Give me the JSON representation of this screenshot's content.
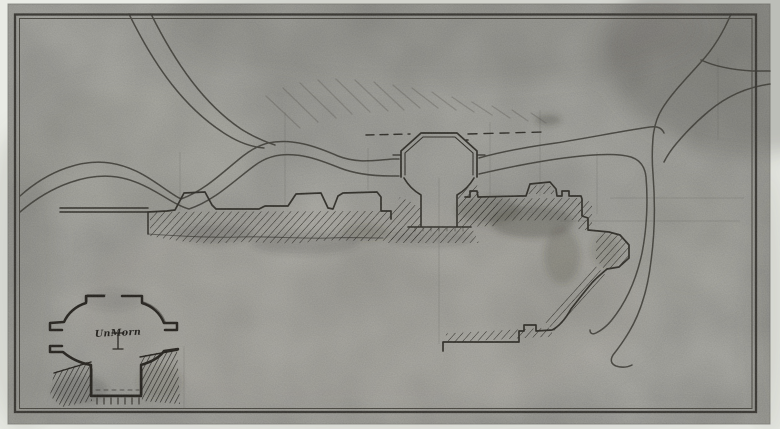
{
  "document": {
    "kind": "scanned hand-drawn architectural site plan",
    "media": "pencil and ink on toned paper"
  },
  "drawing": {
    "elements": [
      "double-line border frame",
      "curving carriage roads",
      "main building plan with hatched poche walls",
      "central octagonal pavilion with stair shaft",
      "detail inset sketch of pavilion plan",
      "handwritten note"
    ]
  },
  "inset": {
    "note_text": "UnMorn"
  },
  "colors": {
    "margin": "#e9ebe5",
    "paper": "#a7a7a1",
    "ink": "#312f29",
    "road": "#413f39",
    "pencil": "#55524a",
    "hatch": "#2d2b26"
  }
}
